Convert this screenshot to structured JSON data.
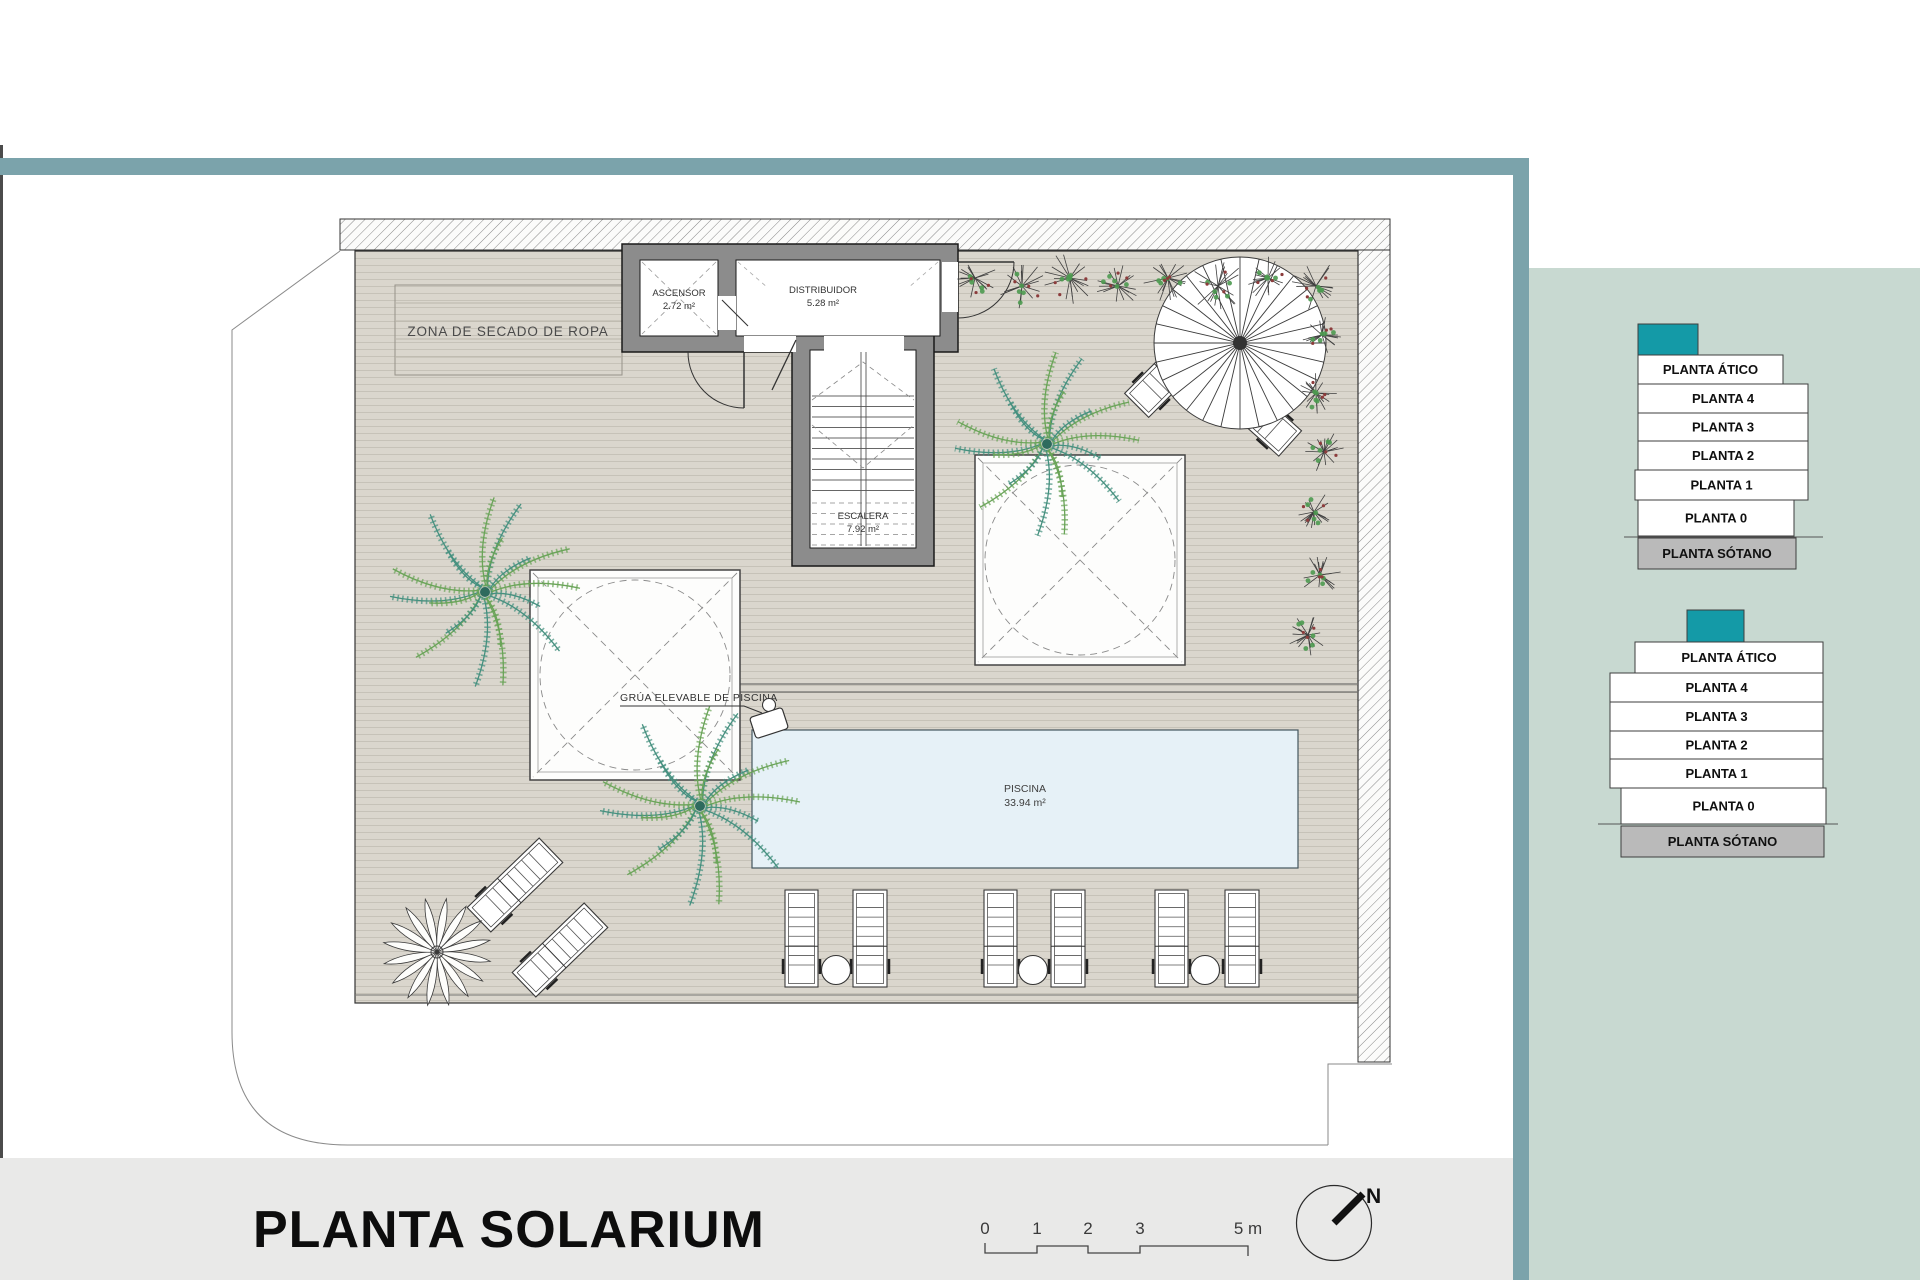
{
  "title": "PLANTA SOLARIUM",
  "colors": {
    "accent_teal": "#149aa7",
    "frame_teal": "#7ba3ab",
    "panel_sage": "#c8d9d1",
    "footer_gray": "#e9e9e8",
    "sotano_gray": "#bababa",
    "pool_blue": "#e6f1f7",
    "deck_tan": "#dad6cd",
    "wall_gray": "#8c8c8c"
  },
  "plan": {
    "zona_label": "ZONA DE SECADO DE ROPA",
    "ascensor": {
      "name": "ASCENSOR",
      "area": "2.72 m²"
    },
    "distribuidor": {
      "name": "DISTRIBUIDOR",
      "area": "5.28 m²"
    },
    "escalera": {
      "name": "ESCALERA",
      "area": "7.92 m²"
    },
    "piscina": {
      "name": "PISCINA",
      "area": "33.94 m²"
    },
    "grua_label": "GRÚA ELEVABLE DE PISCINA"
  },
  "scalebar": {
    "ticks": [
      "0",
      "1",
      "2",
      "3"
    ],
    "end": "5 m"
  },
  "north": "N",
  "stacks": [
    {
      "levels": [
        "PLANTA ÁTICO",
        "PLANTA 4",
        "PLANTA 3",
        "PLANTA 2",
        "PLANTA 1",
        "PLANTA 0",
        "PLANTA SÓTANO"
      ]
    },
    {
      "levels": [
        "PLANTA ÁTICO",
        "PLANTA 4",
        "PLANTA 3",
        "PLANTA 2",
        "PLANTA 1",
        "PLANTA 0",
        "PLANTA SÓTANO"
      ]
    }
  ]
}
